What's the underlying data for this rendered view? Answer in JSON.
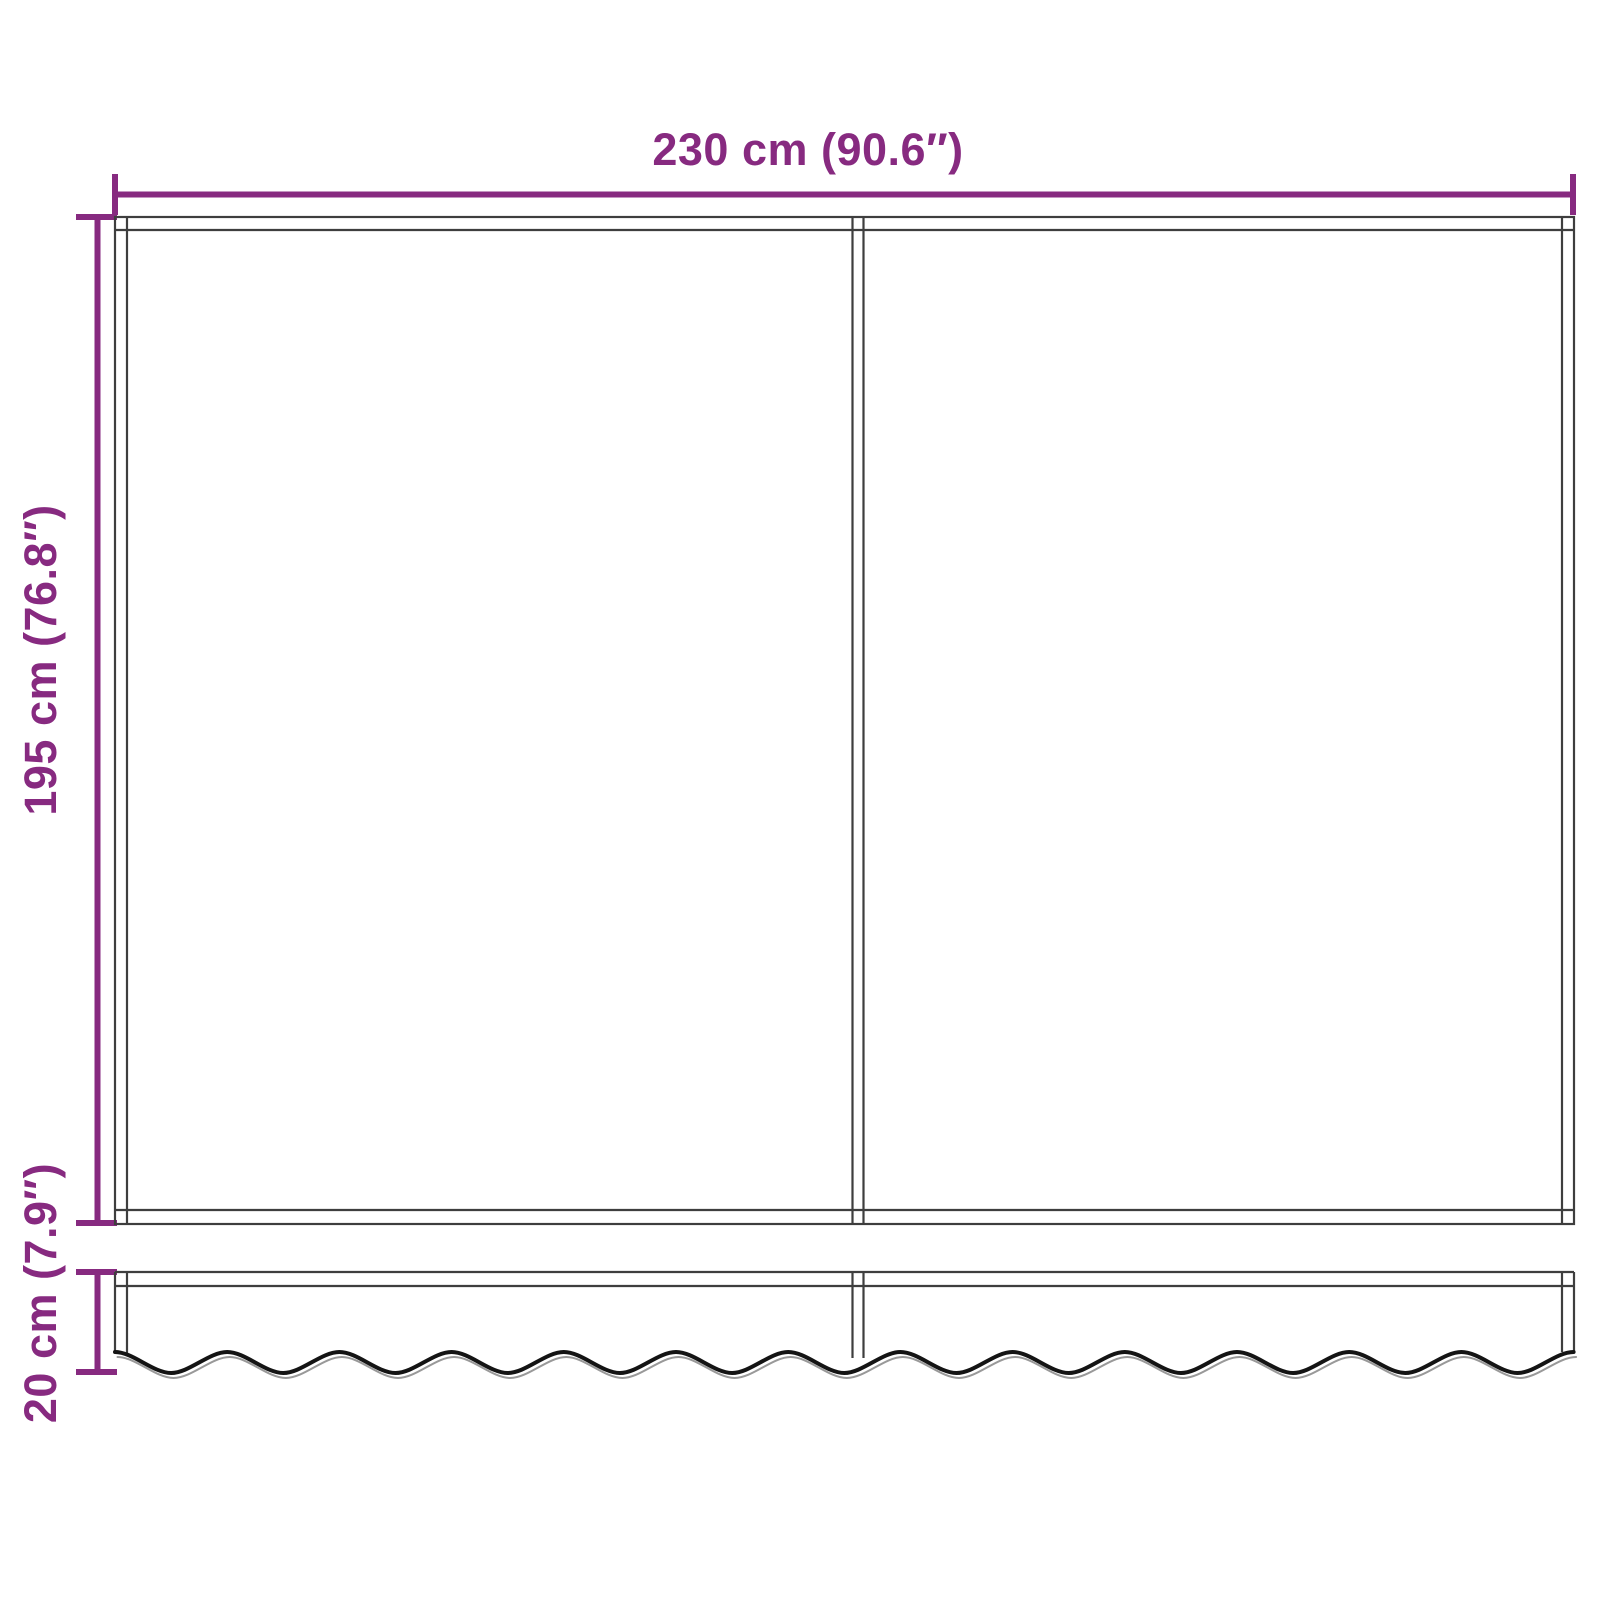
{
  "diagram": {
    "kind": "product-dimension-diagram",
    "subject": "awning-replacement-fabric-with-valance",
    "panels_visible": 2,
    "dimensions": {
      "width": {
        "label": "230 cm (90.6″)",
        "cm": 230,
        "inches": 90.6
      },
      "height": {
        "label": "195 cm (76.8″)",
        "cm": 195,
        "inches": 76.8
      },
      "valance_height": {
        "label": "20 cm (7.9″)",
        "cm": 20,
        "inches": 7.9
      }
    }
  },
  "colors": {
    "dimension": "#872a80",
    "outline": "#3e3e3e",
    "hem": "#141414",
    "hem_shadow": "#999999",
    "background": "#ffffff"
  }
}
